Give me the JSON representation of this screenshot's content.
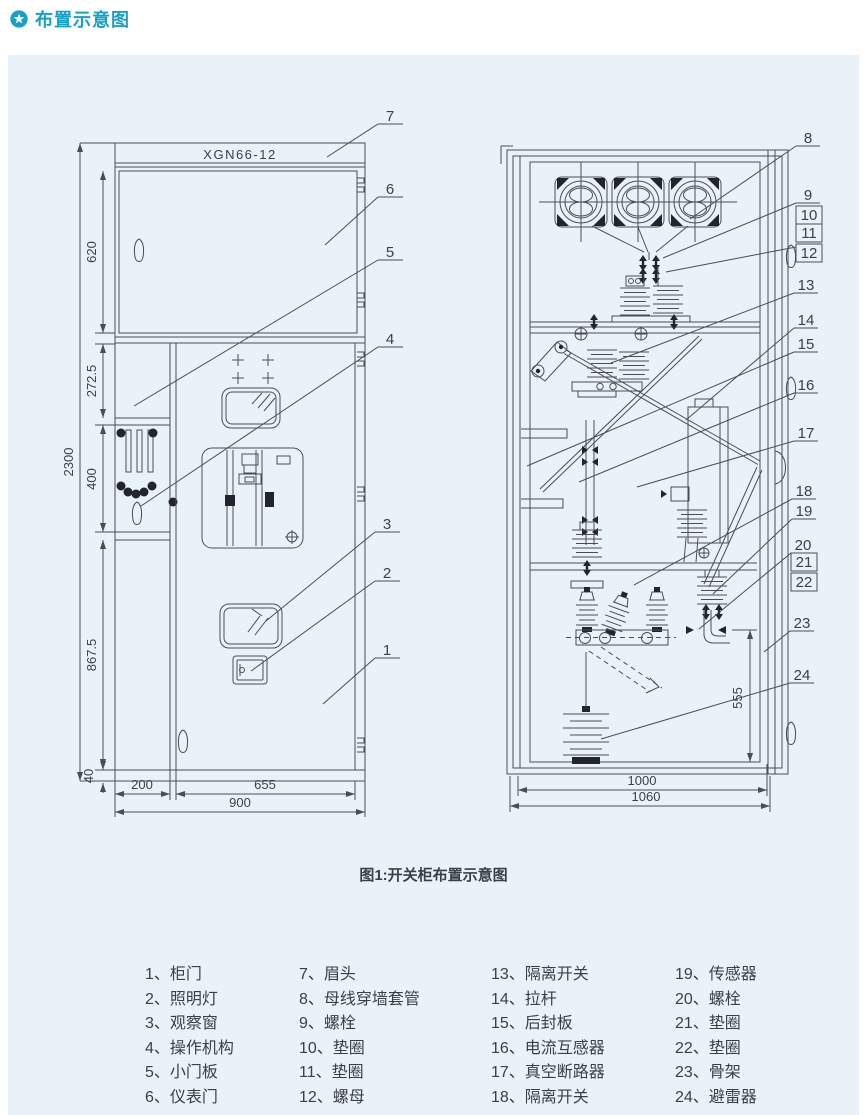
{
  "header": {
    "title": "布置示意图"
  },
  "figure": {
    "model": "XGN66-12",
    "caption": "图1:开关柜布置示意图",
    "front": {
      "height_total": "2300",
      "heights": [
        "620",
        "272.5",
        "400",
        "867.5",
        "40"
      ],
      "widths": [
        "200",
        "655",
        "900"
      ],
      "callouts": [
        "7",
        "6",
        "5",
        "4",
        "3",
        "2",
        "1"
      ]
    },
    "side": {
      "dims": [
        "555",
        "1000",
        "1060"
      ],
      "callouts": [
        "8",
        "9",
        "10",
        "11",
        "12",
        "13",
        "14",
        "15",
        "16",
        "17",
        "18",
        "19",
        "20",
        "21",
        "22",
        "23",
        "24"
      ]
    }
  },
  "legend": {
    "items": [
      "1、柜门",
      "2、照明灯",
      "3、观察窗",
      "4、操作机构",
      "5、小门板",
      "6、仪表门",
      "7、眉头",
      "8、母线穿墙套管",
      "9、螺栓",
      "10、垫圈",
      "11、垫圈",
      "12、螺母",
      "13、隔离开关",
      "14、拉杆",
      "15、后封板",
      "16、电流互感器",
      "17、真空断路器",
      "18、隔离开关",
      "19、传感器",
      "20、螺栓",
      "21、垫圈",
      "22、垫圈",
      "23、骨架",
      "24、避雷器"
    ]
  }
}
